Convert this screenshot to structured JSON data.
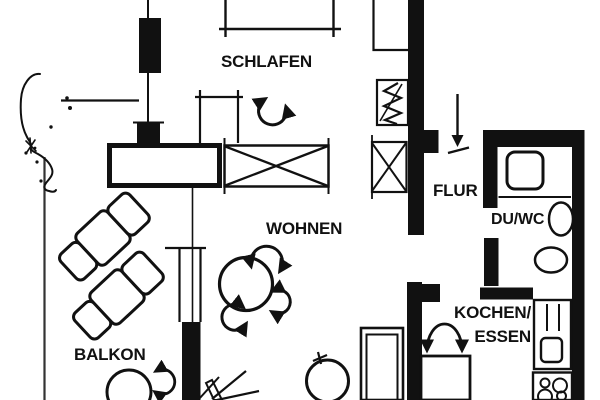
{
  "plan": {
    "type": "floor-plan",
    "colors": {
      "ink": "#111111",
      "paper": "#ffffff"
    },
    "rooms": [
      {
        "id": "schlafen",
        "label": "SCHLAFEN"
      },
      {
        "id": "wohnen",
        "label": "WOHNEN"
      },
      {
        "id": "balkon",
        "label": "BALKON"
      },
      {
        "id": "flur",
        "label": "FLUR"
      },
      {
        "id": "du-wc",
        "label": "DU/WC"
      },
      {
        "id": "kochen-essen",
        "label": "KOCHEN/",
        "label2": "ESSEN"
      }
    ],
    "furniture_icons": [
      "wardrobe-icon",
      "bed-icon",
      "nightstand-icon",
      "rotation-arrow-icon",
      "closet-icon",
      "radiator-icon",
      "entrance-arrow-icon",
      "lounge-chair-icon",
      "round-table-icon",
      "chair-circle-icon",
      "plant-icon",
      "tree-icon",
      "tall-cabinet-icon",
      "door-swing-icon",
      "dining-table-icon",
      "kitchen-counter-icon",
      "sink-icon",
      "stove-icon",
      "shower-icon",
      "washbasin-icon",
      "toilet-icon",
      "window-icon"
    ]
  }
}
